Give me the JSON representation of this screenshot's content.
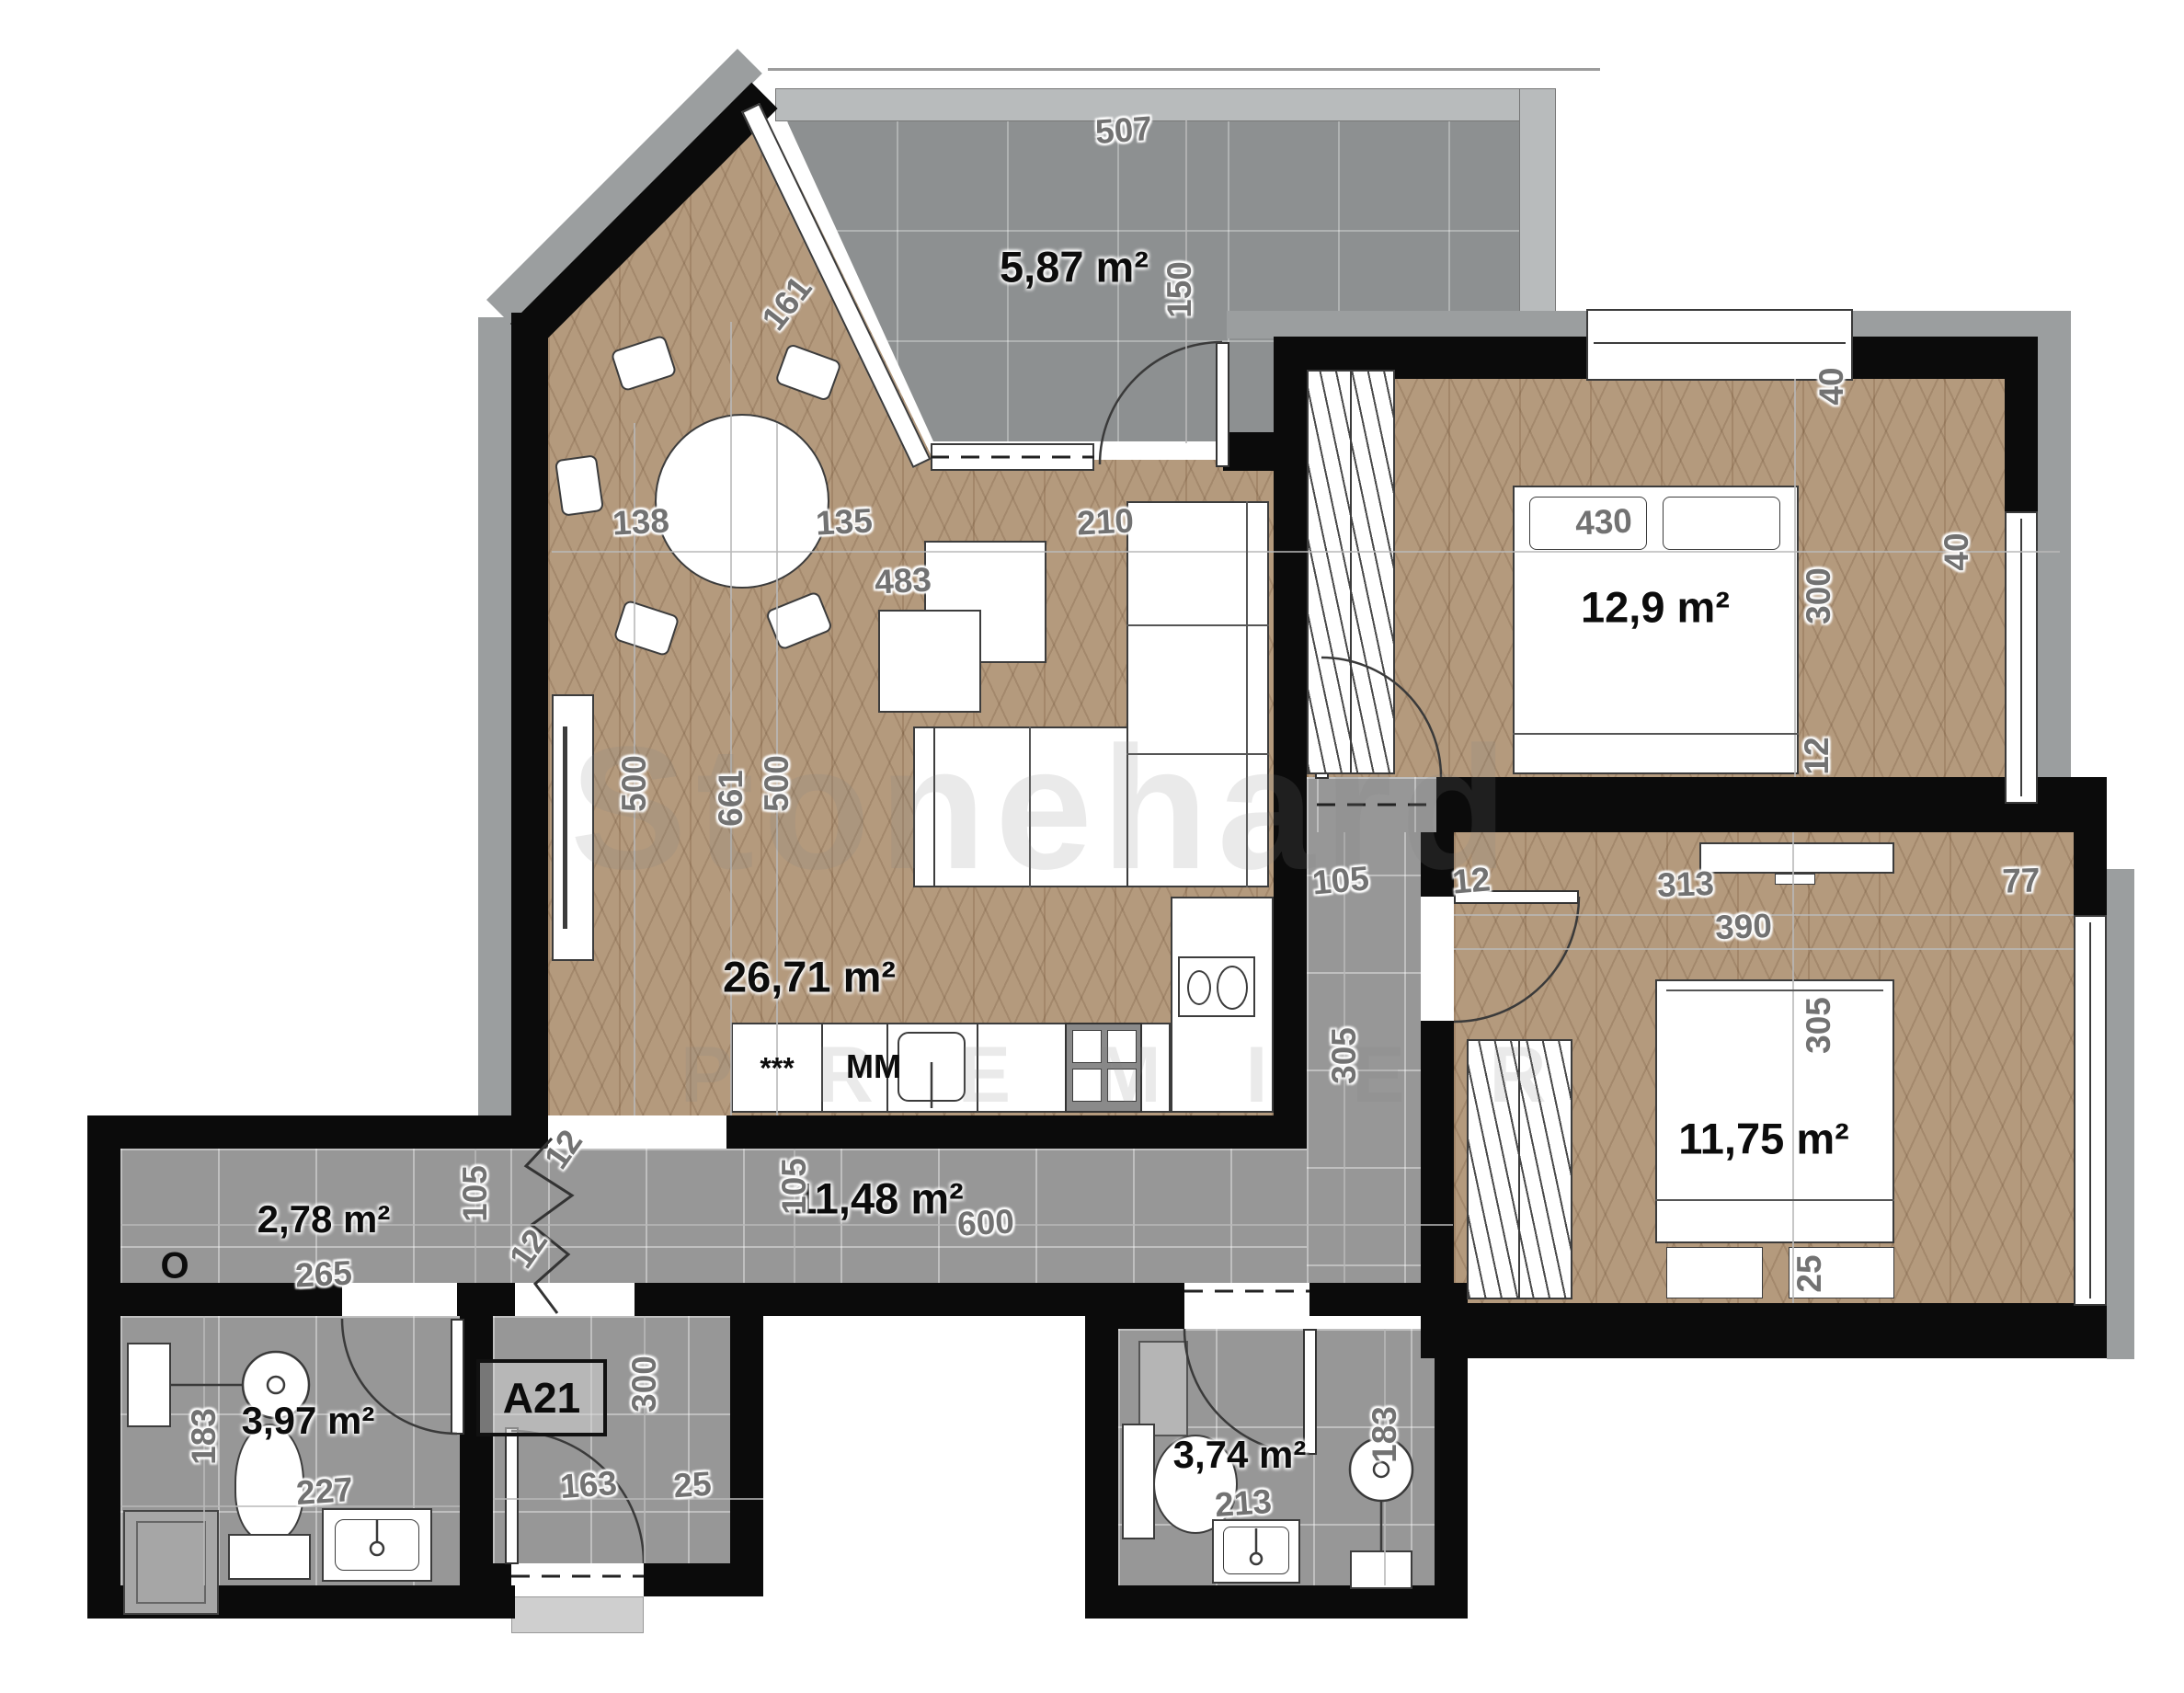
{
  "meta": {
    "unit_label": "A21",
    "watermark_line1": "Stonehard",
    "watermark_line2": "P R E M I E R"
  },
  "colors": {
    "wood": "#b49a7d",
    "tile": "#979797",
    "balcony_tile": "#8d9091",
    "wall": "#0b0b0b",
    "exterior_band": "#9b9e9f"
  },
  "rooms": [
    {
      "id": "balcony",
      "area": "5,87 m²"
    },
    {
      "id": "living-kitchen",
      "area": "26,71 m²"
    },
    {
      "id": "bedroom-1",
      "area": "12,9 m²"
    },
    {
      "id": "bedroom-2",
      "area": "11,75 m²"
    },
    {
      "id": "corridor",
      "area": "11,48 m²"
    },
    {
      "id": "entry",
      "area": "2,78 m²"
    },
    {
      "id": "bathroom-1",
      "area": "3,97 m²"
    },
    {
      "id": "bathroom-2",
      "area": "3,74 m²"
    }
  ],
  "appliances": {
    "dishwasher": "***",
    "washing_machine": "MM",
    "entry_cabinet": "O"
  },
  "dims": [
    "507",
    "150",
    "161",
    "138",
    "135",
    "483",
    "210",
    "430",
    "40",
    "40",
    "300",
    "12",
    "661",
    "500",
    "500",
    "105",
    "12",
    "313",
    "390",
    "77",
    "305",
    "305",
    "25",
    "105",
    "600",
    "12",
    "105",
    "12",
    "265",
    "300",
    "163",
    "25",
    "227",
    "183",
    "213",
    "183"
  ]
}
